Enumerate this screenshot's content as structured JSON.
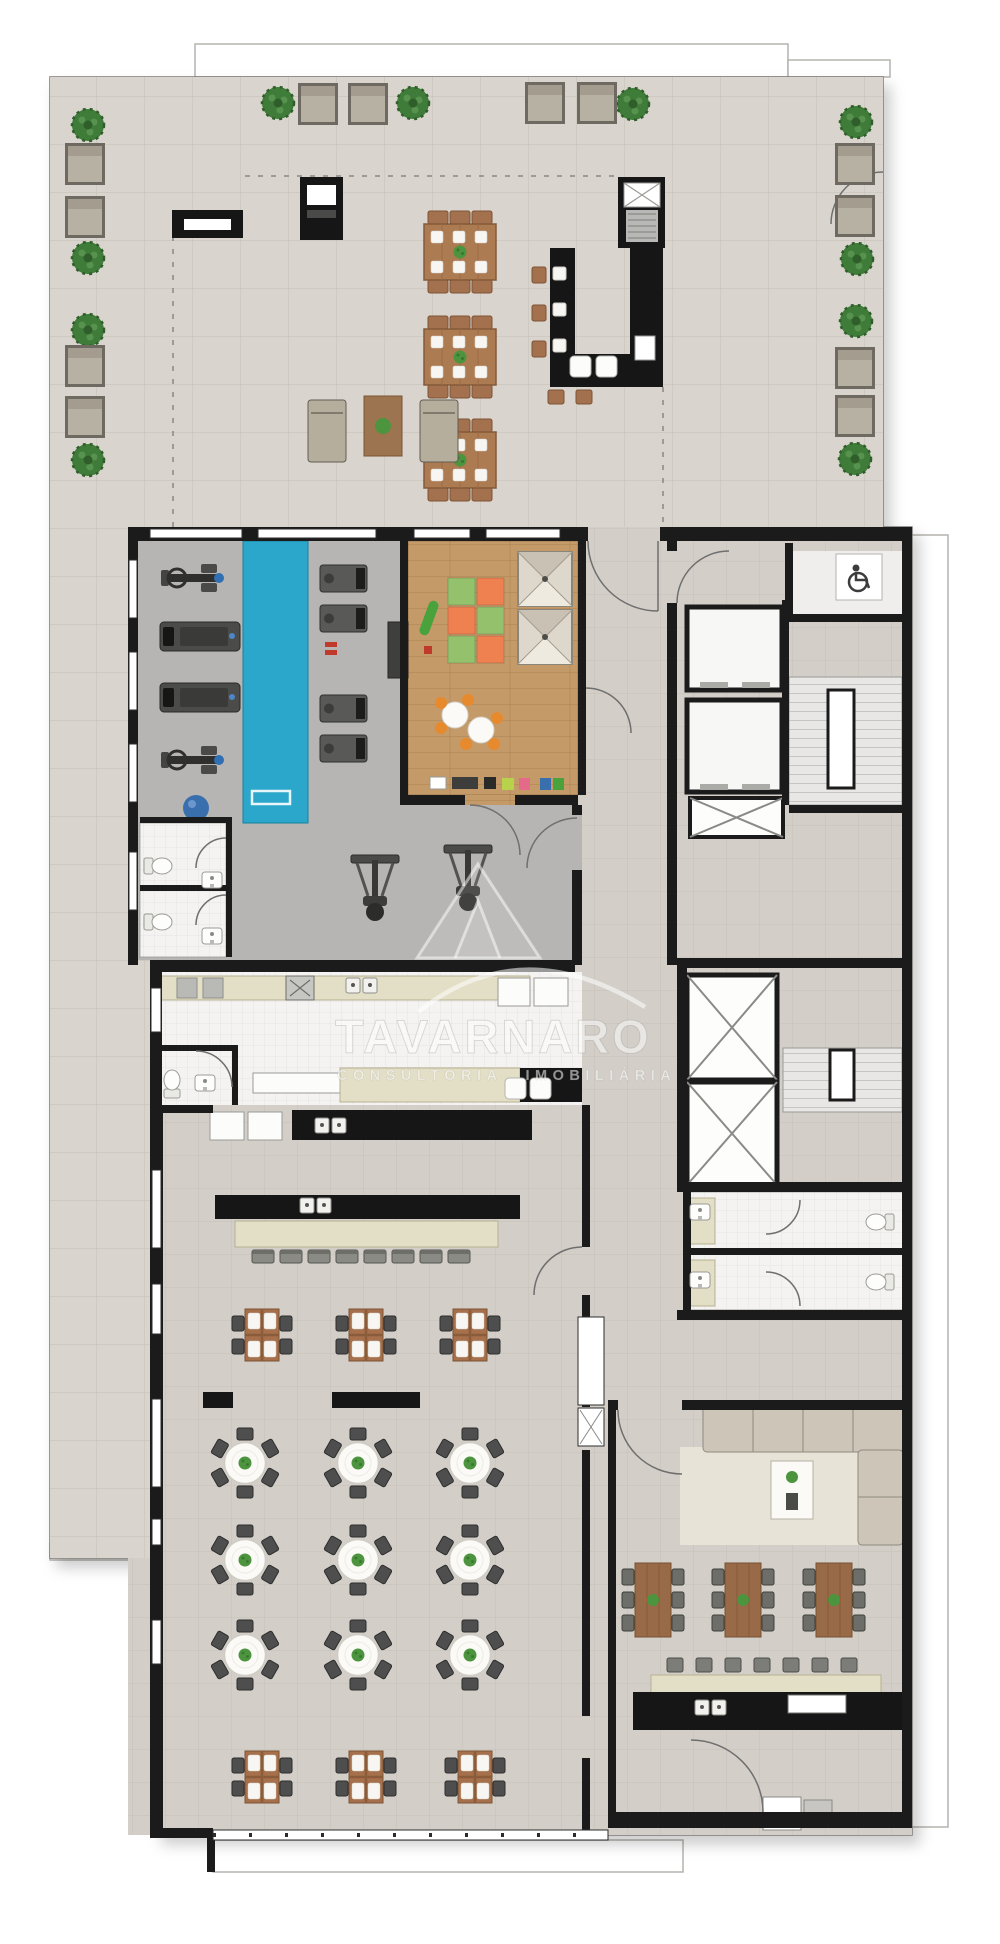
{
  "watermark": {
    "brand": "TAVARNARO",
    "tagline": "CONSULTORIA IMOBILIÁRIA"
  },
  "palette": {
    "page": "#ffffff",
    "terrace_tile": "#d9d5ce",
    "terrace_line": "#c8c4bc",
    "base_tile": "#d3cfc8",
    "base_line": "#c5c1b9",
    "gym_floor": "#b6b5b3",
    "white_room": "#f4f3f1",
    "wall": "#1b1b1b",
    "pool": "#2aa7cb",
    "wood_floor": "#c39a68",
    "mat_green": "#94c16c",
    "mat_orange": "#ef8050",
    "table_wood": "#ad7b52",
    "chair_dark": "#4e4e4e",
    "plate": "#f7f6f2",
    "plant_green": "#4c953e",
    "tree_green": "#3f7c39",
    "seat_gray": "#b7b1a4",
    "counter_beige": "#e3dec6",
    "counter_black": "#161616",
    "sofa": "#cdc6b8",
    "rug": "#e8e3d7"
  },
  "plan": {
    "stamps": {
      "terrace-tree": {
        "sym": "sym-tree",
        "pts": [
          [
            88,
            125
          ],
          [
            88,
            258
          ],
          [
            88,
            330
          ],
          [
            88,
            460
          ],
          [
            278,
            103
          ],
          [
            413,
            103
          ],
          [
            633,
            104
          ],
          [
            856,
            122
          ],
          [
            857,
            259
          ],
          [
            856,
            321
          ],
          [
            855,
            459
          ]
        ]
      },
      "terrace-lounge-seat": {
        "sym": "sym-seat",
        "pts": [
          [
            65,
            143
          ],
          [
            65,
            196
          ],
          [
            65,
            345
          ],
          [
            65,
            396
          ],
          [
            298,
            83
          ],
          [
            348,
            83
          ],
          [
            525,
            82
          ],
          [
            577,
            82
          ],
          [
            835,
            143
          ],
          [
            835,
            195
          ],
          [
            835,
            347
          ],
          [
            835,
            395
          ]
        ]
      },
      "terrace-dining-table": {
        "sym": "sym-table6",
        "pts": [
          [
            460,
            252
          ],
          [
            460,
            357
          ],
          [
            460,
            460
          ]
        ]
      },
      "sun-lounger": {
        "sym": "sym-lounger",
        "pts": [
          [
            308,
            400
          ],
          [
            420,
            400
          ]
        ]
      },
      "play-teepee": {
        "sym": "sym-teepee",
        "pts": [
          [
            518,
            552
          ],
          [
            518,
            610
          ]
        ]
      },
      "round-banquet-table": {
        "sym": "sym-roundtbl",
        "pts": [
          [
            245,
            1463
          ],
          [
            358,
            1463
          ],
          [
            470,
            1463
          ],
          [
            245,
            1560
          ],
          [
            358,
            1560
          ],
          [
            470,
            1560
          ],
          [
            245,
            1655
          ],
          [
            358,
            1655
          ],
          [
            470,
            1655
          ]
        ]
      },
      "square-table-4": {
        "sym": "sym-sqtable4",
        "pts": [
          [
            262,
            1335
          ],
          [
            366,
            1335
          ],
          [
            470,
            1335
          ],
          [
            262,
            1777
          ],
          [
            366,
            1777
          ],
          [
            475,
            1777
          ]
        ]
      },
      "gourmet-table": {
        "sym": "sym-gtable",
        "pts": [
          [
            653,
            1600
          ],
          [
            743,
            1600
          ],
          [
            834,
            1600
          ]
        ]
      },
      "weight-bench": {
        "sym": "sym-wbench",
        "pts": [
          [
            320,
            565
          ],
          [
            320,
            605
          ],
          [
            320,
            695
          ],
          [
            320,
            735
          ]
        ]
      },
      "treadmill": {
        "sym": "sym-treadmill",
        "pts": [
          [
            160,
            622
          ],
          [
            160,
            683
          ]
        ]
      },
      "elliptical-machine": {
        "sym": "sym-cardio",
        "pts": [
          [
            195,
            578
          ],
          [
            195,
            760
          ]
        ]
      },
      "multi-gym-machine": {
        "sym": "sym-multigym",
        "pts": [
          [
            375,
            888
          ],
          [
            468,
            878
          ]
        ]
      },
      "toilet": {
        "sym": "sym-toilet",
        "pts": [
          [
            160,
            866,
            -90
          ],
          [
            160,
            922,
            -90
          ],
          [
            172,
            1082,
            180
          ],
          [
            878,
            1222,
            90
          ],
          [
            878,
            1282,
            90
          ]
        ]
      },
      "washbasin": {
        "sym": "sym-sink",
        "pts": [
          [
            212,
            880
          ],
          [
            212,
            936
          ],
          [
            205,
            1083
          ],
          [
            700,
            1212
          ],
          [
            700,
            1280
          ]
        ]
      },
      "white-stool": {
        "sym": "sym-wstool",
        "pts": [
          [
            570,
            356
          ],
          [
            596,
            356
          ],
          [
            505,
            1078
          ],
          [
            530,
            1078
          ]
        ]
      },
      "banquet-chair": {
        "sym": "sym-bchair",
        "pts": [
          [
            252,
            1250
          ],
          [
            280,
            1250
          ],
          [
            308,
            1250
          ],
          [
            336,
            1250
          ],
          [
            364,
            1250
          ],
          [
            392,
            1250
          ],
          [
            420,
            1250
          ],
          [
            448,
            1250
          ]
        ]
      },
      "bar-stool-gray": {
        "sym": "sym-gstool",
        "pts": [
          [
            667,
            1658
          ],
          [
            696,
            1658
          ],
          [
            725,
            1658
          ],
          [
            754,
            1658
          ],
          [
            783,
            1658
          ],
          [
            812,
            1658
          ],
          [
            841,
            1658
          ]
        ]
      },
      "bar-stool-wood": {
        "sym": "sym-bstool",
        "pts": [
          [
            532,
            267
          ],
          [
            532,
            305
          ],
          [
            532,
            341
          ],
          [
            564,
            390,
            90
          ],
          [
            592,
            390,
            90
          ]
        ]
      },
      "counter-plate": {
        "sym": "sym-plate",
        "pts": [
          [
            553,
            267
          ],
          [
            553,
            303
          ],
          [
            553,
            339
          ]
        ]
      },
      "sink-pair": {
        "sym": "sym-platepair",
        "pts": [
          [
            346,
            978
          ],
          [
            315,
            1118
          ],
          [
            300,
            1198
          ],
          [
            695,
            1700
          ]
        ]
      }
    }
  }
}
